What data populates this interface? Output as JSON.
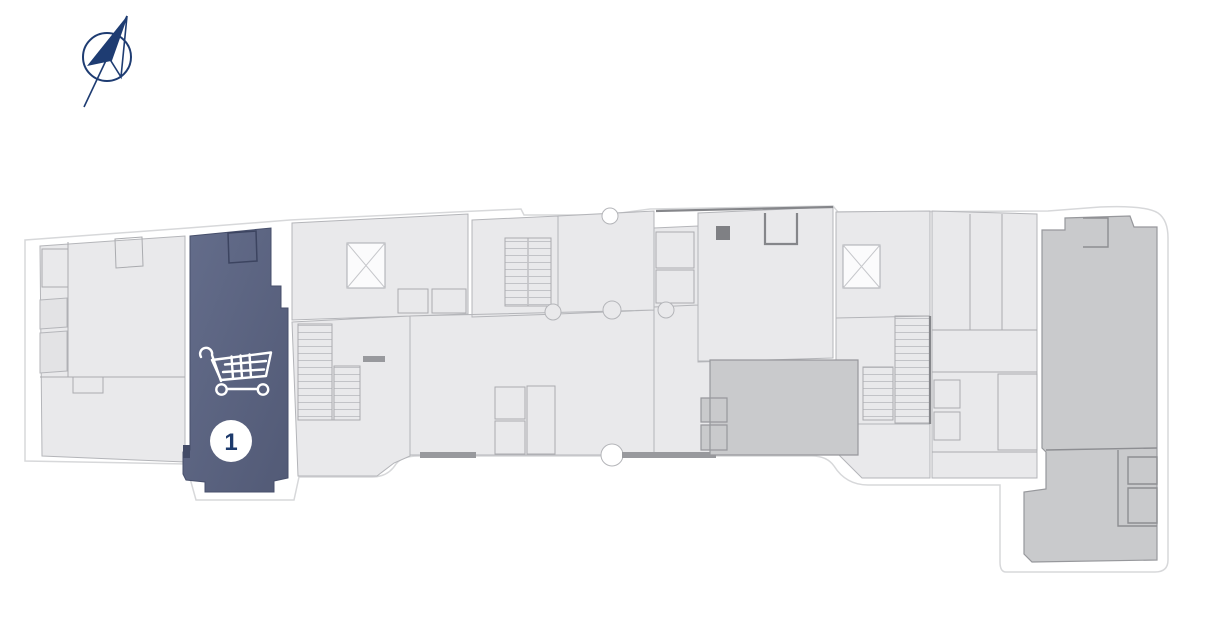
{
  "page": {
    "background": "#ffffff"
  },
  "compass": {
    "icon": "north-arrow-compass",
    "color": "#1e3c72"
  },
  "plan": {
    "type": "building-floor-plan",
    "colors": {
      "outline": "#d7d8da",
      "room_fill": "#e9e9eb",
      "room_fill_alt": "#e3e3e5",
      "room_stroke": "#b4b5b9",
      "inner_line": "#aaabaf",
      "wall": "#85868a",
      "dark_fill": "#98999d",
      "medium_fill": "#c9cacc",
      "medium_stroke": "#97989c"
    },
    "unit1": {
      "label": "1",
      "status": "highlighted",
      "icon": "shopping-cart",
      "fill_top": "#646d8b",
      "fill_bottom": "#525a76",
      "stroke": "#474f6b",
      "icon_color": "#ffffff",
      "badge_bg": "#ffffff",
      "badge_text_color": "#1d3a6c"
    }
  }
}
